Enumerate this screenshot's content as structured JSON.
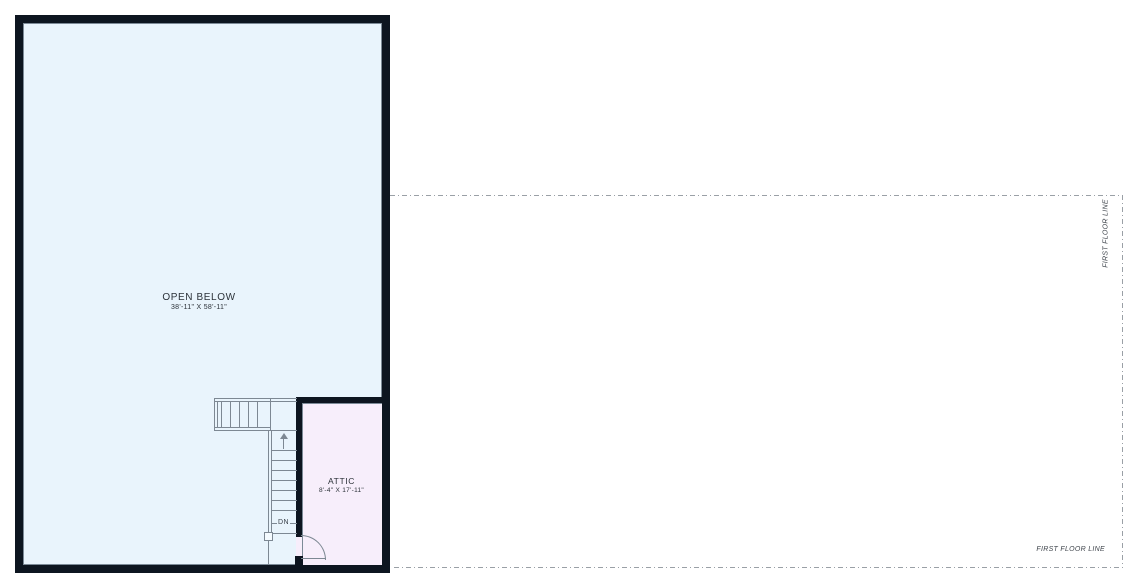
{
  "plan": {
    "open_below": {
      "label": "OPEN BELOW",
      "dimensions": "38'-11\" X 58'-11\""
    },
    "attic": {
      "label": "ATTIC",
      "dimensions": "8'-4\" X 17'-11\""
    },
    "stairs": {
      "direction_label": "DN"
    },
    "reference_lines": {
      "first_floor_line_label": "FIRST FLOOR LINE"
    }
  },
  "colors": {
    "wall": "#0d1520",
    "open-below-fill": "#e9f4fc",
    "attic-fill": "#f7eefb",
    "inner-line": "#7c8a97",
    "stair-line": "#7d8893",
    "dashed-line": "#9aa0a6",
    "label-text": "#2b3138"
  }
}
